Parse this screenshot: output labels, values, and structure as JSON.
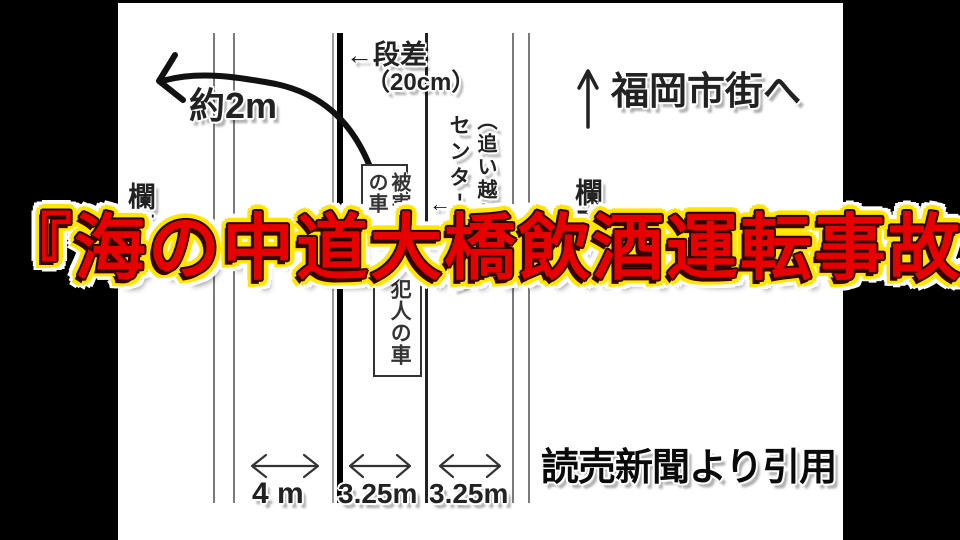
{
  "frame": {
    "background": "#ffffff",
    "letterbox_color": "#000000"
  },
  "title": {
    "text": "『海の中道大橋飲酒運転事故』",
    "fill_color": "#e60000",
    "outline_color": "#ffe600",
    "glow_color": "#ffffff"
  },
  "diagram": {
    "destination": {
      "arrow": "↑",
      "label": "福岡市街へ"
    },
    "step": {
      "arrow_label": "←段差",
      "size_label": "（20cm）"
    },
    "fall": {
      "label": "約2m"
    },
    "railing_left": {
      "label": "欄干",
      "arrow": "→"
    },
    "railing_right": {
      "arrow": "←",
      "label": "欄干"
    },
    "center_line": {
      "arrow": "←",
      "label": "センターライン"
    },
    "overtaking_lane": {
      "label": "（追い越し車線）"
    },
    "victim_car": {
      "label": "被害者の車"
    },
    "culprit_car": {
      "label": "犯人の車"
    },
    "lane_widths": {
      "left": "4 m",
      "middle": "3.25m",
      "right": "3.25m"
    },
    "citation": {
      "label": "読売新聞より引用"
    }
  }
}
